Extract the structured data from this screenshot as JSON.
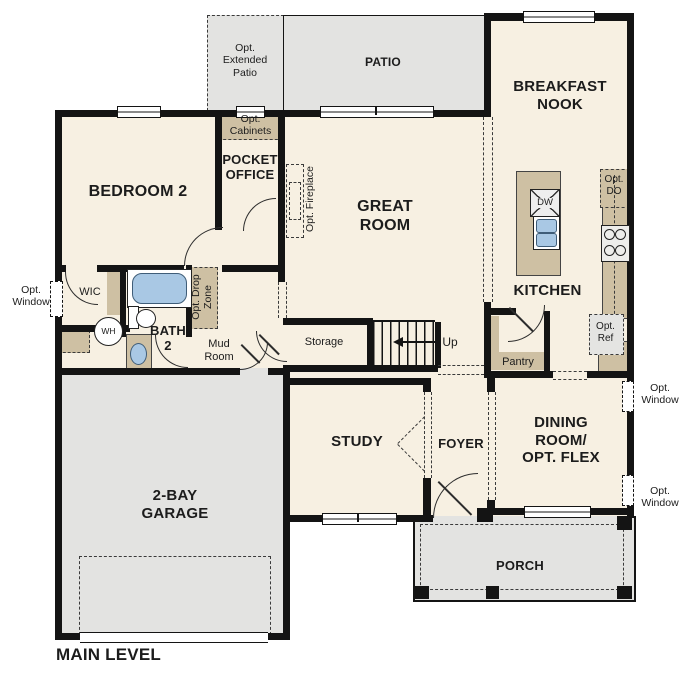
{
  "plan": {
    "title": "MAIN LEVEL",
    "rooms": {
      "bedroom2": "BEDROOM 2",
      "pocket_office": "POCKET\nOFFICE",
      "great_room": "GREAT\nROOM",
      "breakfast_nook": "BREAKFAST\nNOOK",
      "kitchen": "KITCHEN",
      "study": "STUDY",
      "foyer": "FOYER",
      "dining_flex": "DINING\nROOM/\nOPT. FLEX",
      "garage": "2-BAY\nGARAGE",
      "porch": "PORCH",
      "patio": "PATIO",
      "wic": "WIC",
      "bath2": "BATH\n2",
      "mud_room": "Mud\nRoom",
      "storage": "Storage",
      "pantry": "Pantry"
    },
    "options": {
      "extended_patio": "Opt.\nExtended\nPatio",
      "cabinets": "Opt.\nCabinets",
      "fireplace": "Opt. Fireplace",
      "drop_zone": "Opt. Drop\nZone",
      "window": "Opt.\nWindow",
      "double_oven": "Opt.\nDO",
      "refrigerator": "Opt.\nRef"
    },
    "fixtures": {
      "water_heater": "WH",
      "dishwasher": "DW"
    },
    "stairs": {
      "direction": "Up"
    },
    "colors": {
      "interior_floor": "#f7f0e2",
      "concrete": "#e3e3e1",
      "casework_tan": "#cec0a3",
      "plumbing_blue": "#a9c8e4",
      "wall_black": "#141414"
    }
  }
}
